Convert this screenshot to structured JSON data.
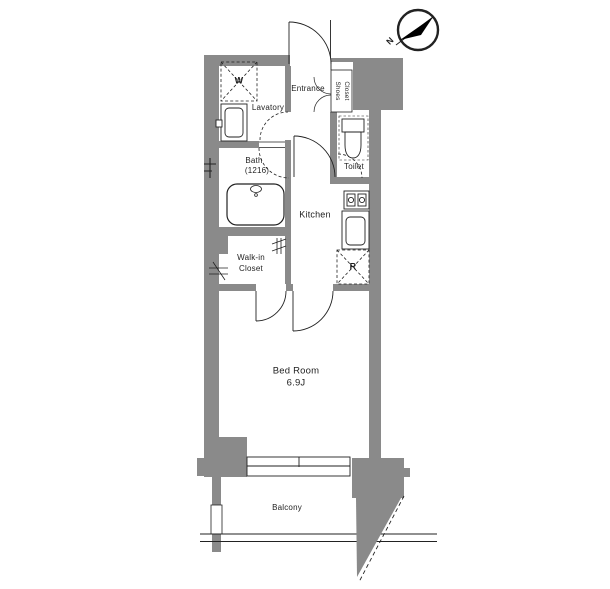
{
  "compass": {
    "north_label": "N"
  },
  "rooms": {
    "entrance": "Entrance",
    "shoes_closet_line1": "Shoes",
    "shoes_closet_line2": "Closet",
    "lavatory": "Lavatory",
    "bath_line1": "Bath",
    "bath_line2": "(1216)",
    "toilet": "Toilet",
    "kitchen": "Kitchen",
    "walkin_closet_line1": "Walk-in",
    "walkin_closet_line2": "Closet",
    "bedroom_line1": "Bed Room",
    "bedroom_line2": "6.9J",
    "balcony": "Balcony"
  },
  "appliances": {
    "washer_mark": "W",
    "refrigerator_mark": "R"
  },
  "colors": {
    "wall": "#8a8a8a",
    "line": "#222222",
    "background": "#ffffff"
  }
}
